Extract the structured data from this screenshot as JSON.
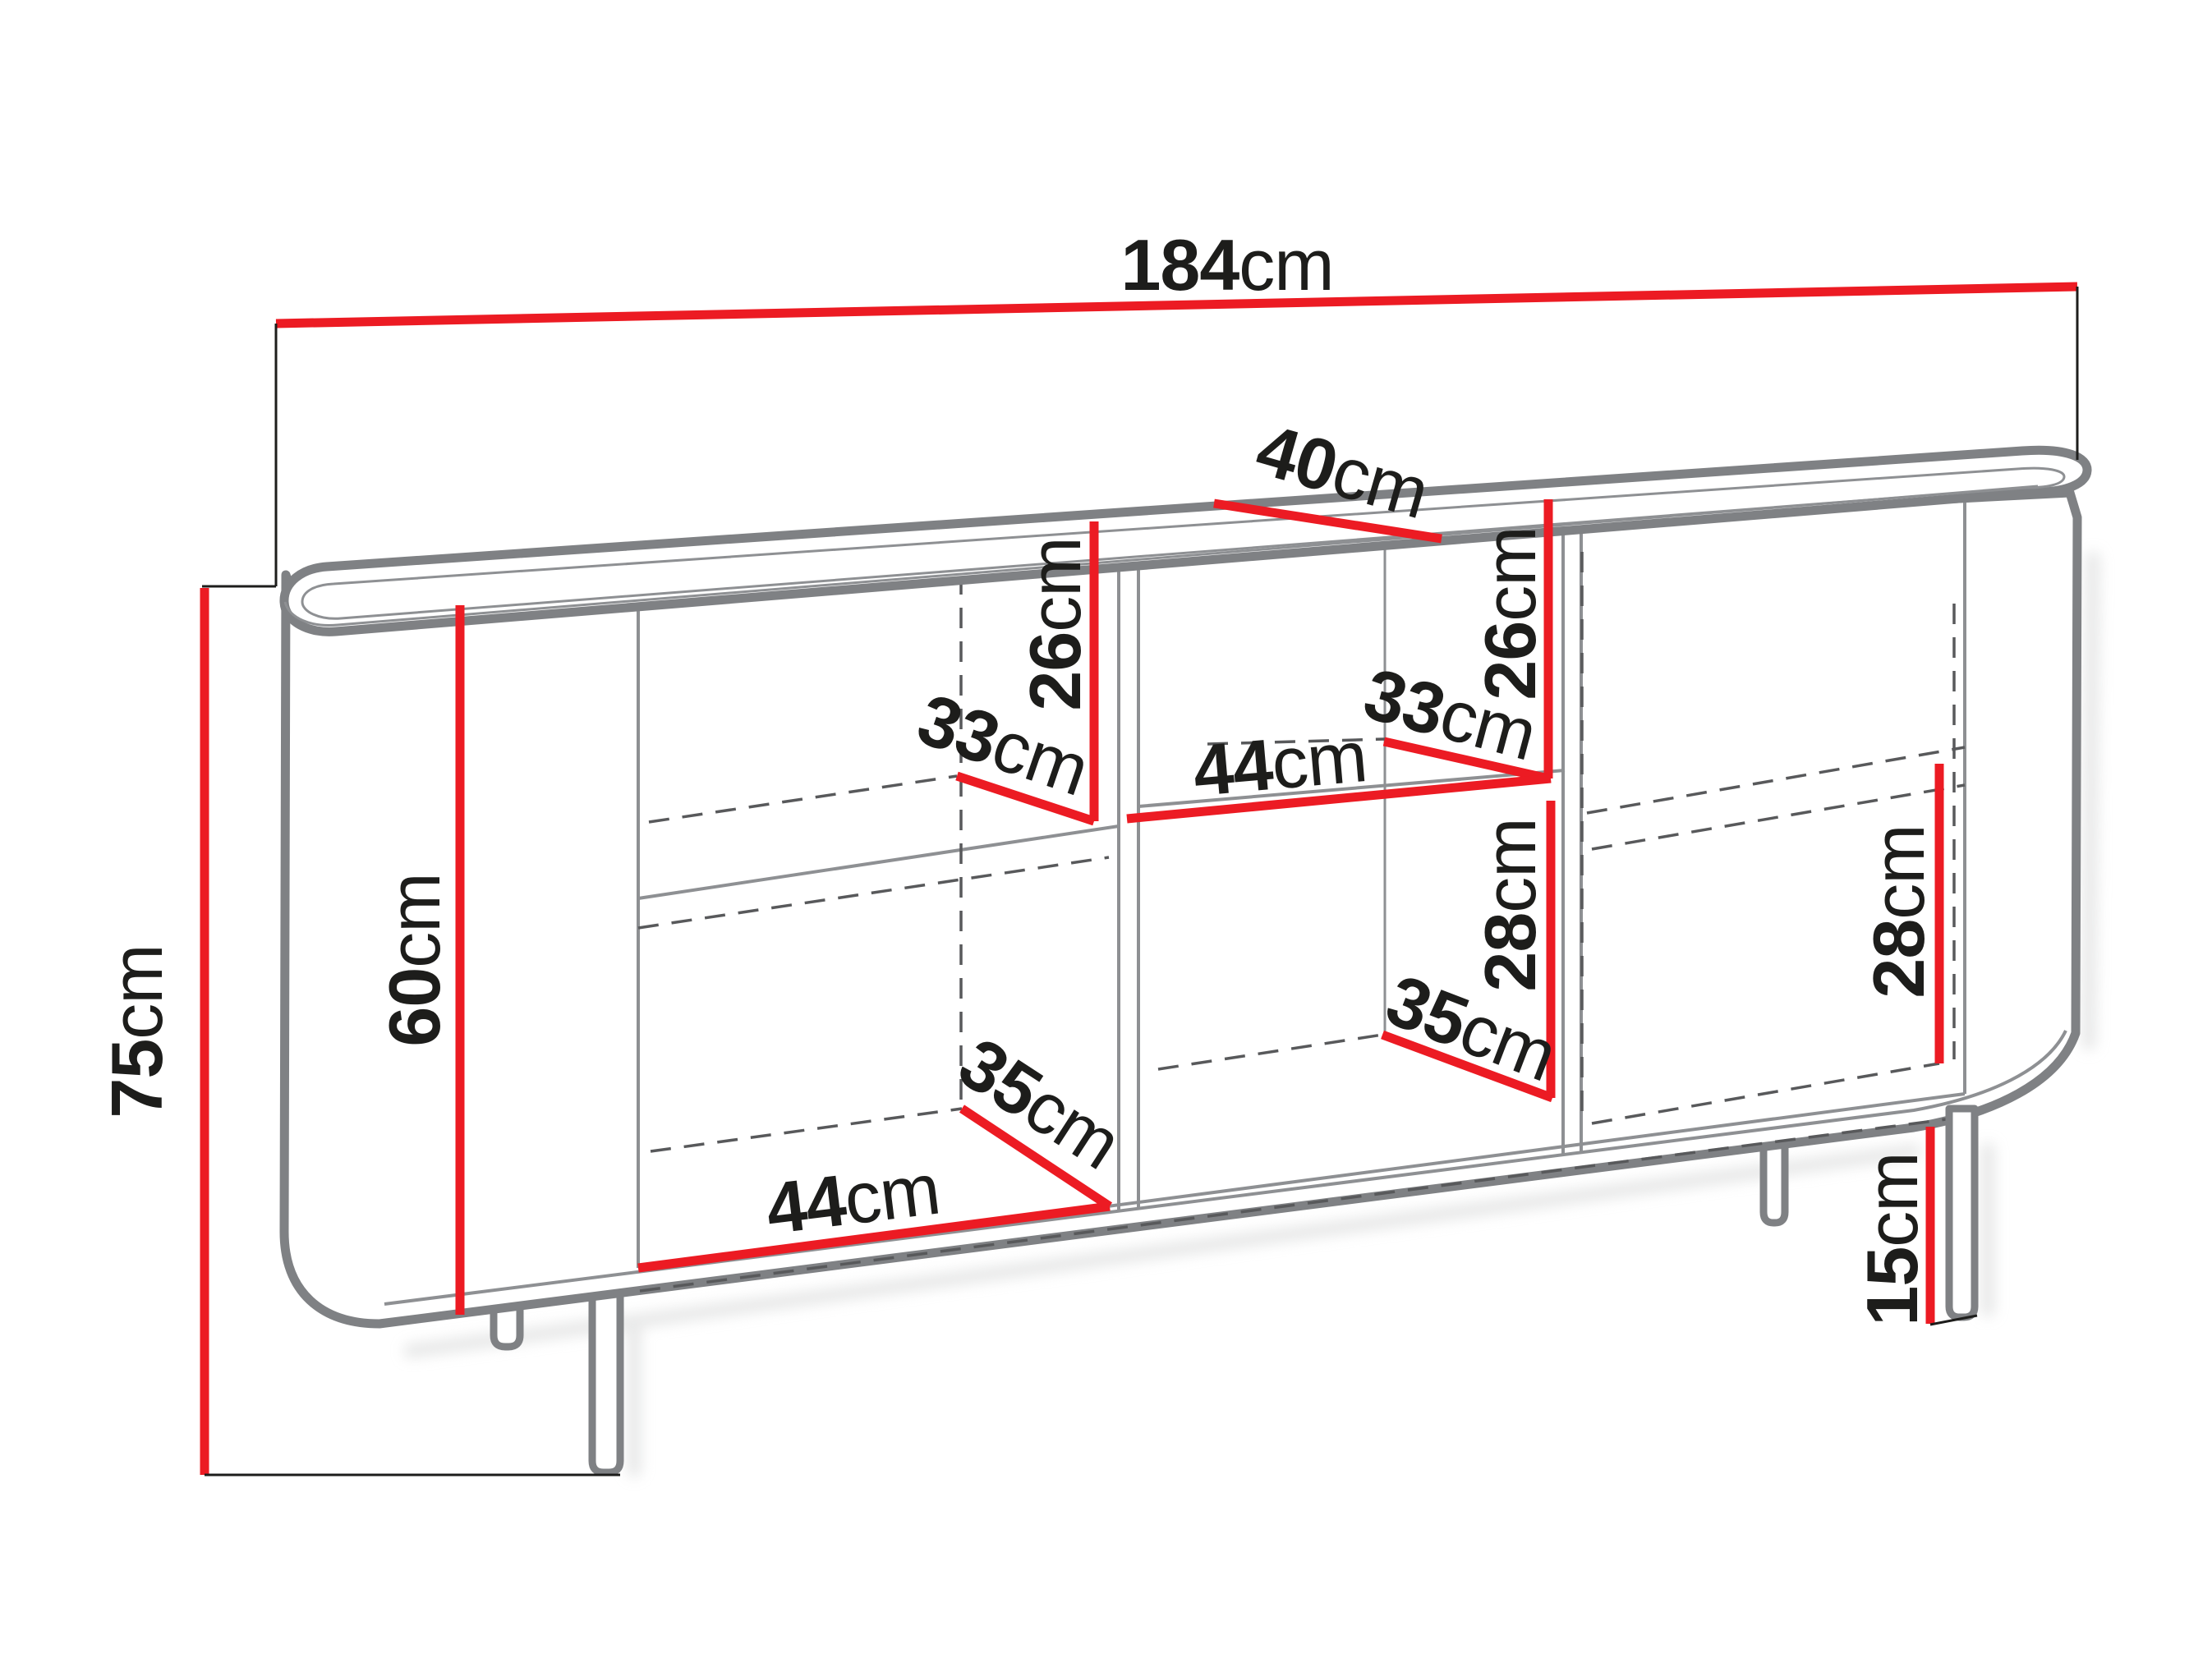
{
  "page": {
    "title": "Sideboard dimension diagram",
    "description": "Line drawing of a sideboard with rounded ends on four legs, open carcass with shelves, annotated with red dimension lines"
  },
  "colors": {
    "dimension_line": "#ec1b23",
    "outline": "#7f8184",
    "thin_line": "#8e9093",
    "dashed_line": "#58595b",
    "extension_line": "#1d1d1b",
    "text": "#1d1d1b",
    "background": "#ffffff",
    "shadow": "#dcdddd"
  },
  "labels": {
    "width_total": {
      "value": "184",
      "unit": "cm"
    },
    "top_depth": {
      "value": "40",
      "unit": "cm"
    },
    "height_total": {
      "value": "75",
      "unit": "cm"
    },
    "interior_height": {
      "value": "60",
      "unit": "cm"
    },
    "left_upper_height": {
      "value": "26",
      "unit": "cm"
    },
    "left_upper_depth": {
      "value": "33",
      "unit": "cm"
    },
    "left_lower_depth": {
      "value": "35",
      "unit": "cm"
    },
    "left_lower_width": {
      "value": "44",
      "unit": "cm"
    },
    "center_upper_height": {
      "value": "26",
      "unit": "cm"
    },
    "center_upper_depth": {
      "value": "33",
      "unit": "cm"
    },
    "center_shelf_width": {
      "value": "44",
      "unit": "cm"
    },
    "center_lower_height": {
      "value": "28",
      "unit": "cm"
    },
    "center_lower_depth": {
      "value": "35",
      "unit": "cm"
    },
    "right_lower_height": {
      "value": "28",
      "unit": "cm"
    },
    "leg_height": {
      "value": "15",
      "unit": "cm"
    }
  }
}
